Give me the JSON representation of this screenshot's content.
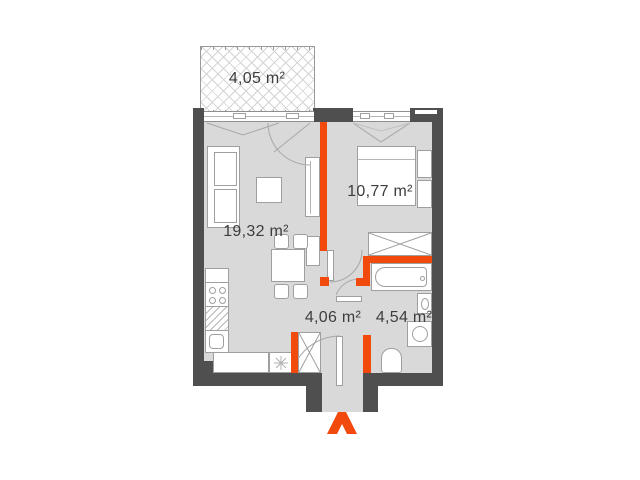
{
  "rooms": {
    "balcony": {
      "name": "balcony",
      "label": "4,05 m²"
    },
    "living": {
      "name": "living-kitchen",
      "label": "19,32 m²"
    },
    "bedroom": {
      "name": "bedroom",
      "label": "10,77 m²"
    },
    "hall": {
      "name": "hall",
      "label": "4,06 m²"
    },
    "bathroom": {
      "name": "bathroom",
      "label": "4,54 m²"
    }
  },
  "colors": {
    "accent_wall": "#f2490c",
    "structural_wall": "#4f4f4f",
    "floor": "#d9d9d9",
    "label_text": "#3d3d3d"
  },
  "entrance": {
    "marker": "chevron-up-icon"
  }
}
